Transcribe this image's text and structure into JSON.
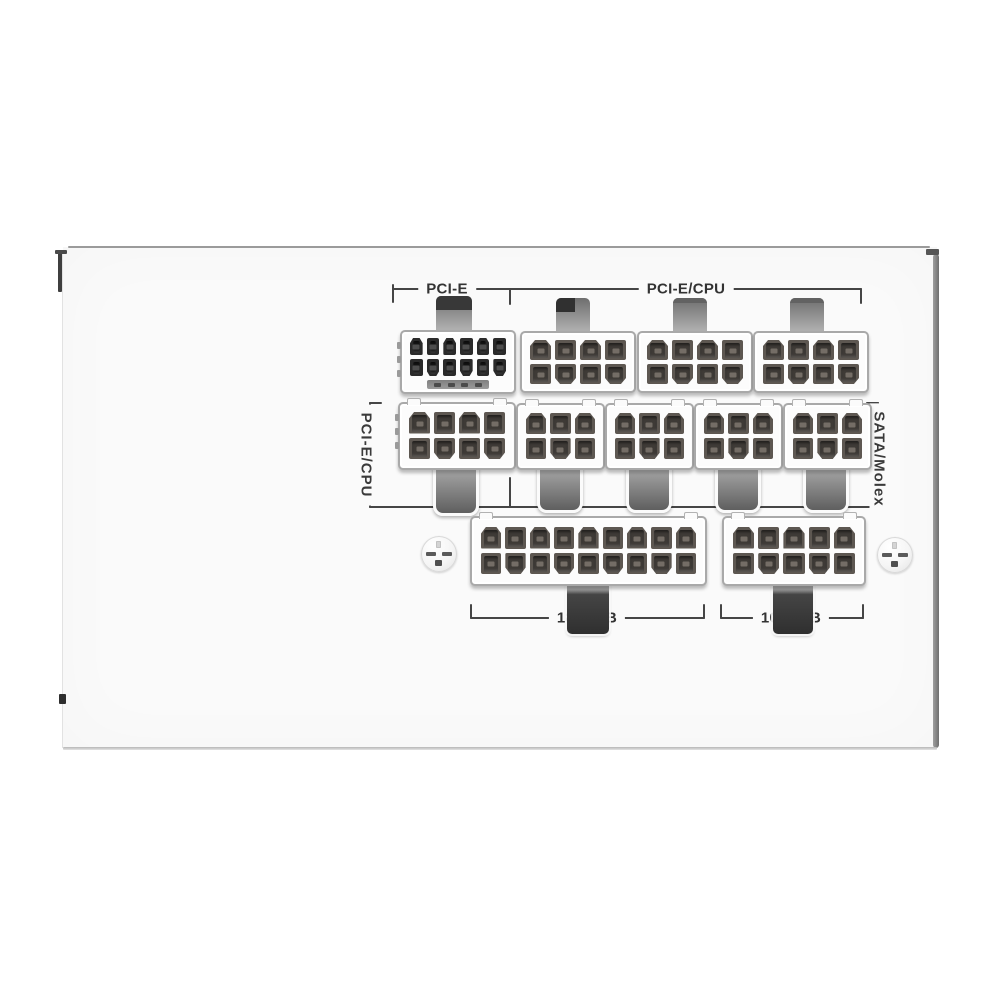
{
  "labels": {
    "pcie_top": "PCI-E",
    "pcie_cpu_top": "PCI-E/CPU",
    "pcie_cpu_side": "PCI-E/CPU",
    "sata_molex_side": "SATA/Molex",
    "mb_18p": "18P M/B",
    "mb_10p": "10P M/B"
  },
  "colors": {
    "panel": "#fafafa",
    "bracket_line": "#454545",
    "label_text": "#333333",
    "pin_body": "#5d5751",
    "pin_body_dark": "#2a2a2a",
    "connector_body": "#fcfcfc"
  },
  "connector_groups": [
    {
      "label": "PCI-E",
      "sockets": [
        {
          "id": "A",
          "name": "pcie-12plus4-socket",
          "rows": 2,
          "cols": 6,
          "pins": 12,
          "sense_pins": 4,
          "pin_style": "dark"
        }
      ]
    },
    {
      "label": "PCI-E/CPU",
      "sockets": [
        {
          "id": "B",
          "name": "pcie-cpu-8pin-socket-1",
          "rows": 2,
          "cols": 4,
          "pins": 8
        },
        {
          "id": "C",
          "name": "pcie-cpu-8pin-socket-2",
          "rows": 2,
          "cols": 4,
          "pins": 8
        },
        {
          "id": "D",
          "name": "pcie-cpu-8pin-socket-3",
          "rows": 2,
          "cols": 4,
          "pins": 8
        }
      ]
    },
    {
      "label": "PCI-E/CPU",
      "sockets": [
        {
          "id": "M1",
          "name": "pcie-cpu-8pin-socket-4",
          "rows": 2,
          "cols": 4,
          "pins": 8
        }
      ]
    },
    {
      "label": "SATA/Molex",
      "sockets": [
        {
          "id": "M2",
          "name": "sata-molex-6pin-socket-1",
          "rows": 2,
          "cols": 3,
          "pins": 6
        },
        {
          "id": "M3",
          "name": "sata-molex-6pin-socket-2",
          "rows": 2,
          "cols": 3,
          "pins": 6
        },
        {
          "id": "M4",
          "name": "sata-molex-6pin-socket-3",
          "rows": 2,
          "cols": 3,
          "pins": 6
        },
        {
          "id": "M5",
          "name": "sata-molex-6pin-socket-4",
          "rows": 2,
          "cols": 3,
          "pins": 6
        }
      ]
    },
    {
      "label": "18P M/B",
      "sockets": [
        {
          "id": "B18",
          "name": "mainboard-18pin-socket",
          "rows": 2,
          "cols": 9,
          "pins": 18
        }
      ]
    },
    {
      "label": "10P M/B",
      "sockets": [
        {
          "id": "B10",
          "name": "mainboard-10pin-socket",
          "rows": 2,
          "cols": 5,
          "pins": 10
        }
      ]
    }
  ],
  "screws": {
    "count": 2
  }
}
